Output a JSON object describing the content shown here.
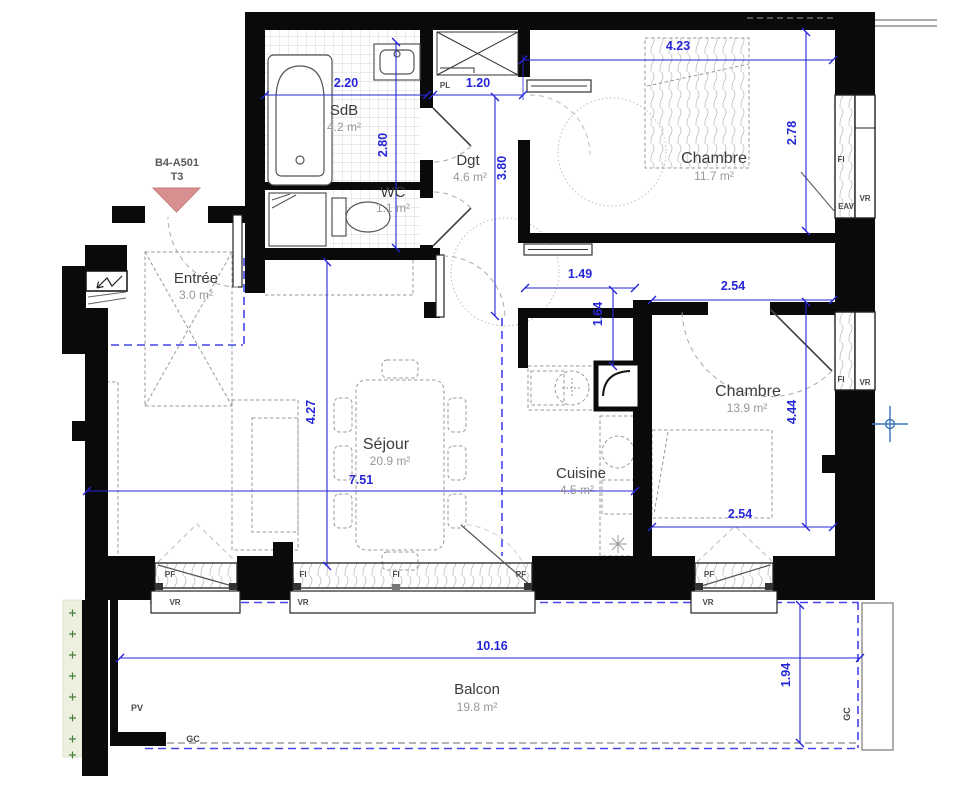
{
  "plan": {
    "lot": {
      "id": "B4-A501",
      "type": "T3"
    },
    "rooms": {
      "sdb": {
        "label": "SdB",
        "area": "4.2 m²"
      },
      "wc": {
        "label": "WC",
        "area": "1.1 m²"
      },
      "dgt": {
        "label": "Dgt",
        "area": "4.6 m²"
      },
      "chambre1": {
        "label": "Chambre",
        "area": "11.7 m²"
      },
      "chambre2": {
        "label": "Chambre",
        "area": "13.9 m²"
      },
      "sejour": {
        "label": "Séjour",
        "area": "20.9 m²"
      },
      "cuisine": {
        "label": "Cuisine",
        "area": "4.5 m²"
      },
      "entree": {
        "label": "Entrée",
        "area": "3.0 m²"
      },
      "balcon": {
        "label": "Balcon",
        "area": "19.8 m²"
      }
    },
    "dims": {
      "sdb_w": "2.20",
      "sdb_h": "2.80",
      "dgt_w": "1.20",
      "dgt_h": "3.80",
      "ch1_w": "4.23",
      "ch1_h": "2.78",
      "corr_w": "1.49",
      "corr_h": "1.64",
      "ch2_w": "2.54",
      "ch2_h": "4.44",
      "sejour_h": "4.27",
      "sejour_w": "7.51",
      "balcon_w": "10.16",
      "balcon_h": "1.94"
    },
    "tags": {
      "pl": "PL",
      "fi": "FI",
      "vr": "VR",
      "pf": "PF",
      "eav": "EAV",
      "pv": "PV",
      "gc": "GC"
    },
    "colors": {
      "dim_blue": "#2626d8",
      "zone_blue": "#4343e8",
      "wall": "#0a0a0a",
      "marker_red": "#d88f8f"
    }
  }
}
